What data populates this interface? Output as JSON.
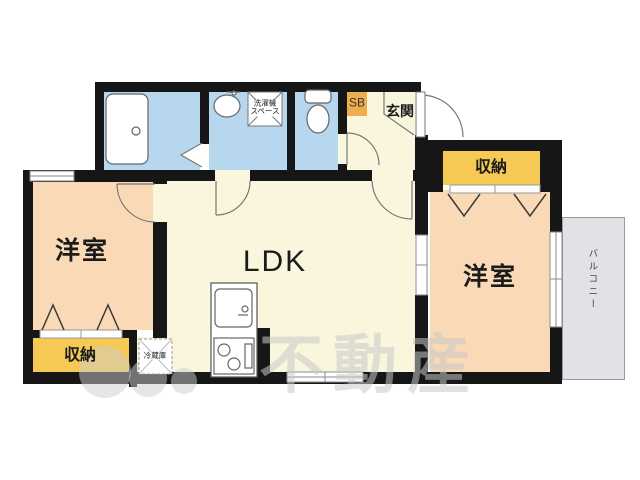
{
  "rooms": {
    "ldk": {
      "label": "LDK"
    },
    "bedroom_left": {
      "label": "洋室"
    },
    "bedroom_right": {
      "label": "洋室"
    },
    "entrance": {
      "label": "玄関"
    },
    "shoe_box": {
      "label": "SB"
    },
    "storage_left": {
      "label": "収納"
    },
    "storage_right": {
      "label": "収納"
    },
    "balcony": {
      "label": "バルコニー"
    }
  },
  "fixtures": {
    "washing_machine_space": {
      "label": "洗濯機\nスペース"
    },
    "refrigerator": {
      "label": "冷蔵庫"
    },
    "bathtub": {
      "icon": "bathtub-icon"
    },
    "washbasin": {
      "icon": "washbasin-icon"
    },
    "toilet": {
      "icon": "toilet-icon"
    },
    "kitchen": {
      "icon": "kitchen-unit-icon"
    }
  },
  "watermark": {
    "text": "不動産"
  },
  "colors": {
    "wall": "#161616",
    "wet-area": "#b7d7ef",
    "living": "#faf6dd",
    "bedroom": "#f9d9b6",
    "storage": "#f6c854",
    "shoebox": "#eeae4d",
    "balcony": "#e2e1e6"
  }
}
